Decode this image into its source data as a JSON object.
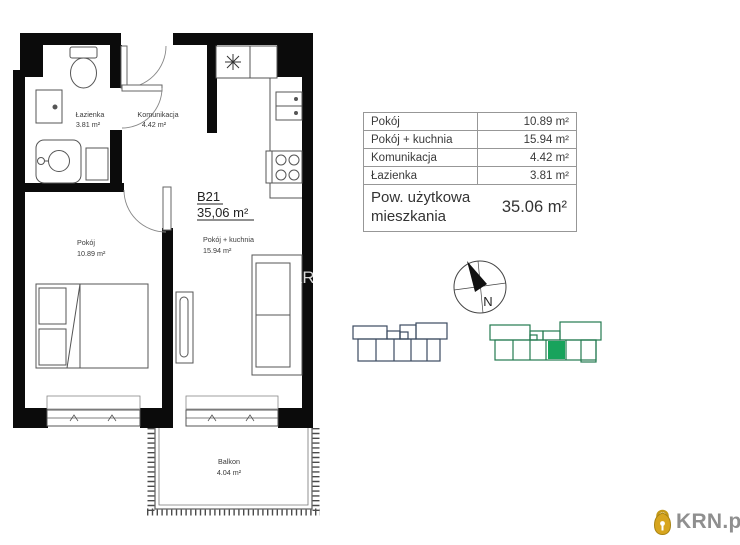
{
  "plan": {
    "unit_id": "B21",
    "unit_area": "35,06 m²",
    "rooms": {
      "lazienka": {
        "name": "Łazienka",
        "area": "3.81 m²"
      },
      "komunikacja": {
        "name": "Komunikacja",
        "area": "4.42 m²"
      },
      "pokoj": {
        "name": "Pokój",
        "area": "10.89 m²"
      },
      "pokoj_kuchnia": {
        "name": "Pokój + kuchnia",
        "area": "15.94 m²"
      },
      "balkon": {
        "name": "Balkon",
        "area": "4.04 m²"
      }
    },
    "watermark": "KRN.pl"
  },
  "area_table": {
    "rows": [
      {
        "label": "Pokój",
        "value": "10.89 m²"
      },
      {
        "label": "Pokój + kuchnia",
        "value": "15.94 m²"
      },
      {
        "label": "Komunikacja",
        "value": "4.42 m²"
      },
      {
        "label": "Łazienka",
        "value": "3.81 m²"
      }
    ],
    "summary_label": "Pow. użytkowa mieszkania",
    "summary_value": "35.06 m²"
  },
  "compass": {
    "north_label": "N"
  },
  "site_plan": {
    "building1_outline": "#3b4a60",
    "building2_outline": "#237a4f",
    "highlight_color": "#18a35c"
  },
  "logo": {
    "text": "KRN.pl",
    "lock_color": "#d7a51e",
    "text_color": "#8f8f8f"
  }
}
